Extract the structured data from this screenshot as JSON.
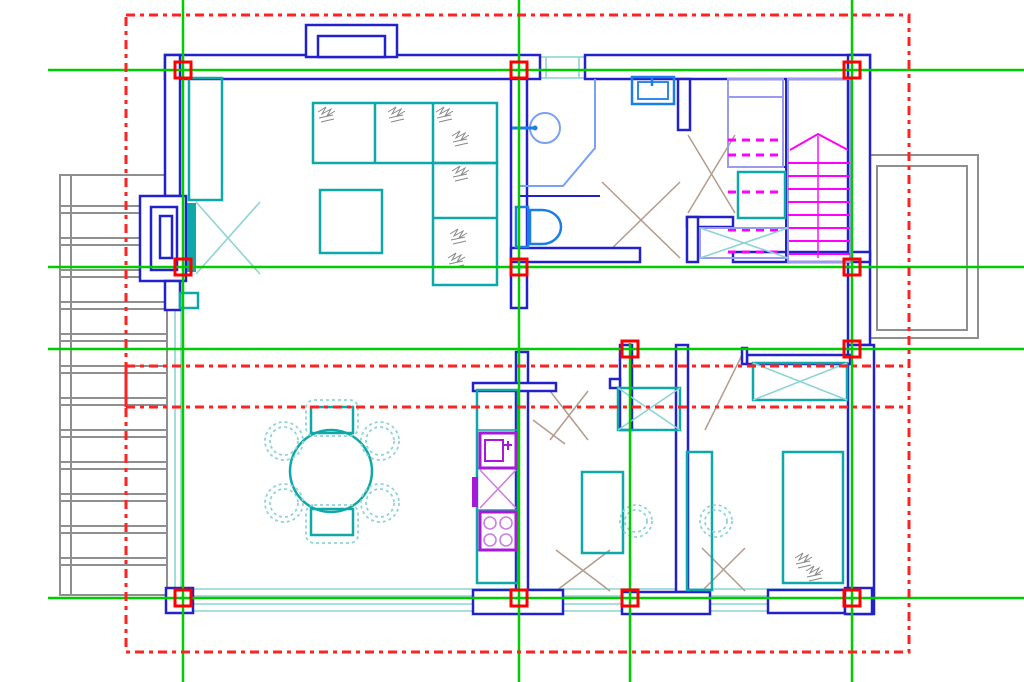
{
  "app": {
    "name": "cad-floor-plan-view",
    "description": "First-floor architectural plan with structural grid axes and dashed roof outline overlay"
  },
  "canvas": {
    "width": 1024,
    "height": 682,
    "background": "#ffffff"
  },
  "colors": {
    "wall": "#2222cc",
    "fixblue": "#1a7ee6",
    "lblue": "#9a9af0",
    "pblue": "#7aa0f5",
    "teal": "#0fa8a8",
    "lteal": "#8fd4d4",
    "magenta": "#ff00ff",
    "purple": "#a818d8",
    "lpurple": "#cc7fe0",
    "green": "#00cc00",
    "red": "#ff2222",
    "markerred": "#ff0000",
    "gray": "#8f8f8f",
    "tan": "#b39b8d",
    "scrib": "#888888"
  },
  "grid": {
    "vertical_lines": [
      {
        "x": 183,
        "y1": 0,
        "y2": 682
      },
      {
        "x": 519,
        "y1": 0,
        "y2": 682
      },
      {
        "x": 630,
        "y1": 343,
        "y2": 682
      },
      {
        "x": 852,
        "y1": 0,
        "y2": 682
      }
    ],
    "horizontal_lines": [
      {
        "y": 70,
        "x1": 48,
        "x2": 1024
      },
      {
        "y": 267,
        "x1": 48,
        "x2": 1024
      },
      {
        "y": 349,
        "x1": 48,
        "x2": 1024
      },
      {
        "y": 598,
        "x1": 48,
        "x2": 1024
      }
    ],
    "markers": [
      [
        183,
        70
      ],
      [
        519,
        70
      ],
      [
        852,
        70
      ],
      [
        183,
        267
      ],
      [
        519,
        267
      ],
      [
        852,
        267
      ],
      [
        630,
        349
      ],
      [
        852,
        349
      ],
      [
        183,
        598
      ],
      [
        519,
        598
      ],
      [
        630,
        598
      ],
      [
        852,
        598
      ]
    ],
    "marker_size": 16
  },
  "roof_overlay": {
    "outer_rect": {
      "x": 126,
      "y": 15,
      "width": 783,
      "height": 637
    },
    "ridge_lines_y": [
      366,
      407
    ],
    "left_solid_segment": {
      "x": 126,
      "y1": 366,
      "y2": 407
    },
    "dash": "9 5 4 5",
    "stroke_width": 3
  },
  "rooms": [
    {
      "name": "living-room",
      "bbox": [
        180,
        80,
        511,
        345
      ]
    },
    {
      "name": "bathroom",
      "bbox": [
        527,
        80,
        678,
        248
      ]
    },
    {
      "name": "hall",
      "bbox": [
        640,
        130,
        848,
        267
      ]
    },
    {
      "name": "staircase",
      "bbox": [
        728,
        79,
        850,
        262
      ]
    },
    {
      "name": "dining-room",
      "bbox": [
        181,
        345,
        516,
        588
      ]
    },
    {
      "name": "kitchen",
      "bbox": [
        477,
        383,
        528,
        592
      ]
    },
    {
      "name": "study",
      "bbox": [
        528,
        345,
        676,
        592
      ]
    },
    {
      "name": "bedroom",
      "bbox": [
        688,
        364,
        848,
        590
      ]
    },
    {
      "name": "exterior-stair",
      "bbox": [
        60,
        175,
        167,
        595
      ]
    },
    {
      "name": "balcony",
      "bbox": [
        868,
        155,
        978,
        338
      ]
    }
  ],
  "furniture": [
    {
      "name": "corner-sofa",
      "bbox": [
        313,
        103,
        497,
        285
      ]
    },
    {
      "name": "coffee-table",
      "bbox": [
        320,
        190,
        382,
        253
      ]
    },
    {
      "name": "entry-wardrobe",
      "bbox": [
        189,
        78,
        222,
        200
      ]
    },
    {
      "name": "dining-table",
      "center": [
        331,
        471
      ],
      "radius": 41,
      "seats": 6
    },
    {
      "name": "kitchen-counter",
      "bbox": [
        477,
        390,
        518,
        583
      ]
    },
    {
      "name": "kitchen-sink",
      "bbox": [
        480,
        433,
        516,
        468
      ]
    },
    {
      "name": "stove",
      "bbox": [
        480,
        512,
        516,
        550
      ]
    },
    {
      "name": "washbasin",
      "center": [
        545,
        128
      ],
      "radius": 15
    },
    {
      "name": "toilet",
      "bbox": [
        516,
        207,
        561,
        247
      ]
    },
    {
      "name": "washing-machine",
      "bbox": [
        632,
        77,
        674,
        104
      ]
    },
    {
      "name": "bed",
      "bbox": [
        783,
        452,
        843,
        583
      ]
    },
    {
      "name": "desk-study",
      "bbox": [
        582,
        472,
        623,
        553
      ]
    },
    {
      "name": "desk-bedroom",
      "bbox": [
        687,
        452,
        712,
        590
      ]
    },
    {
      "name": "wardrobe-bedroom",
      "bbox": [
        753,
        363,
        847,
        400
      ]
    },
    {
      "name": "wardrobe-study",
      "bbox": [
        618,
        388,
        680,
        430
      ]
    },
    {
      "name": "understair-closet",
      "bbox": [
        700,
        228,
        788,
        258
      ]
    }
  ]
}
